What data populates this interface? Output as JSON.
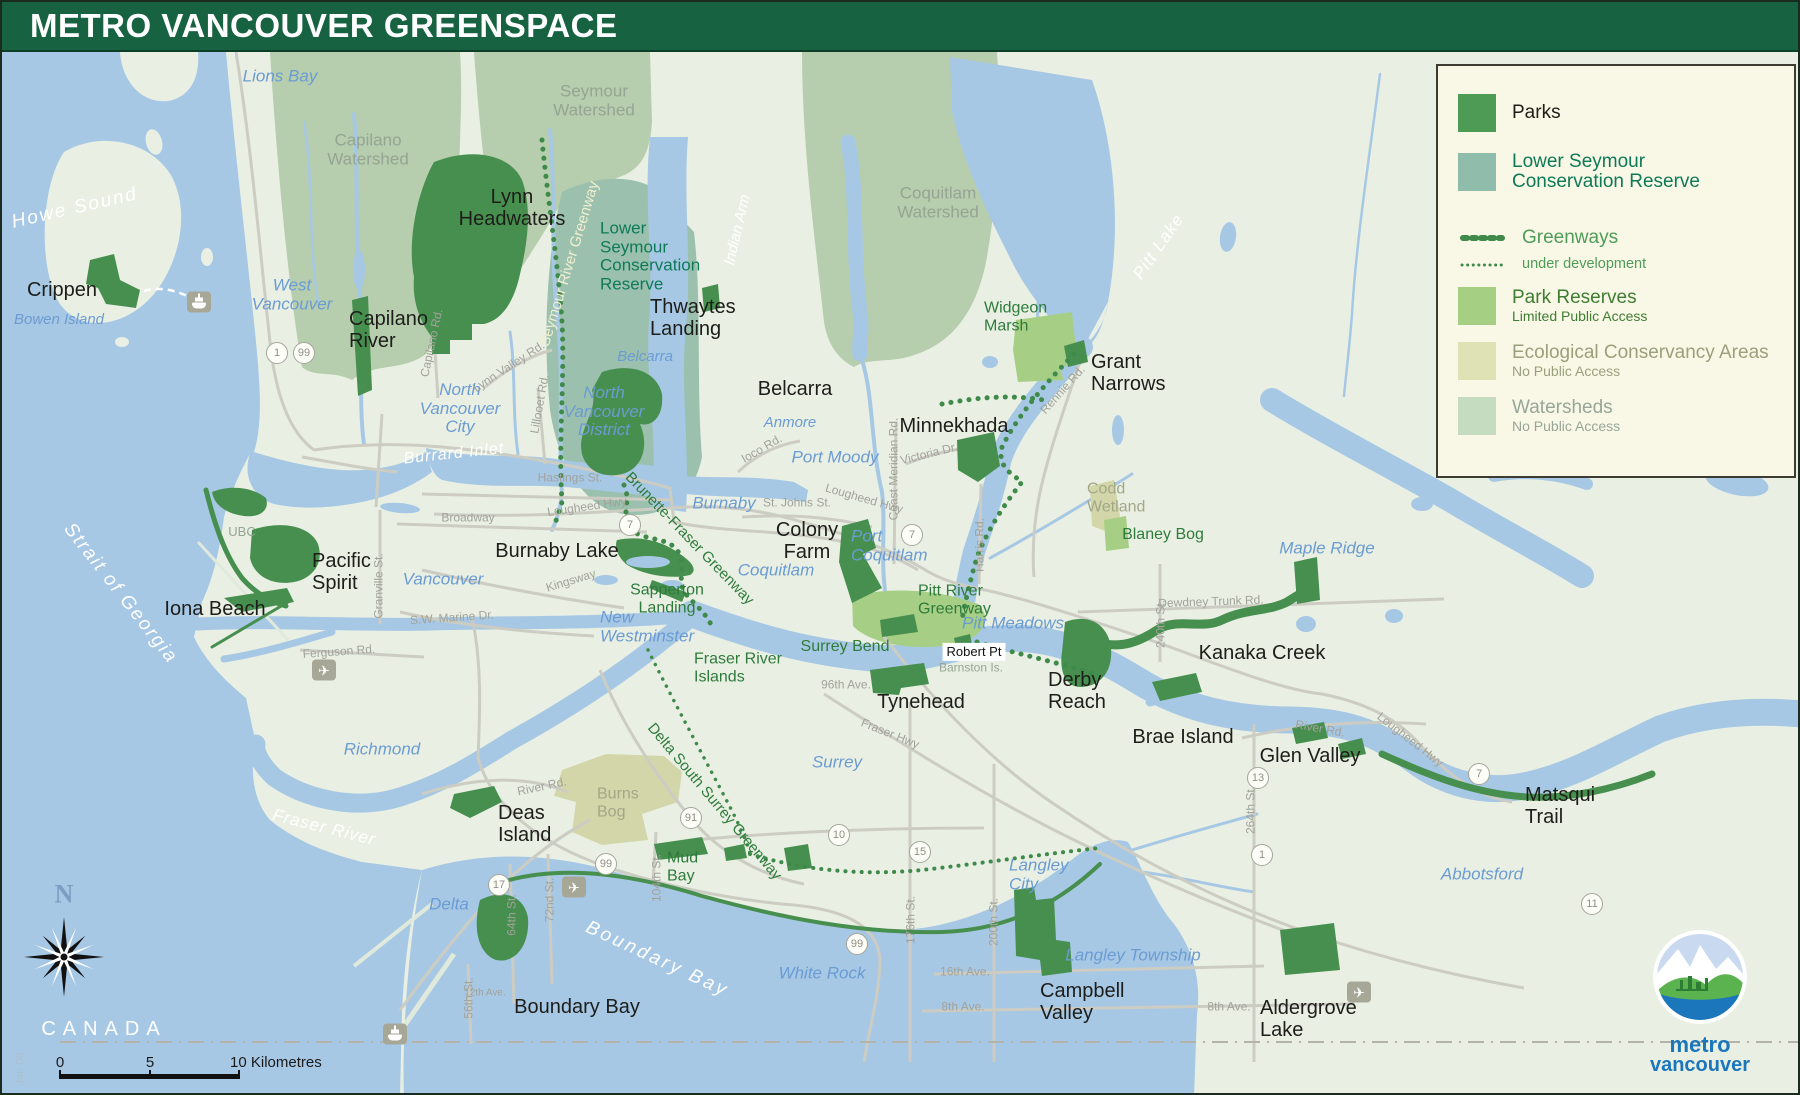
{
  "title": "METRO VANCOUVER GREENSPACE",
  "legend": {
    "items": [
      {
        "label": "Parks",
        "swatch": "#4e9b55"
      },
      {
        "label": "Lower Seymour\nConservation Reserve",
        "swatch": "#8fbcab"
      },
      {
        "label": "Greenways"
      },
      {
        "label": "under development"
      },
      {
        "label": "Park Reserves",
        "sub": "Limited Public Access",
        "swatch": "#a5cf82"
      },
      {
        "label": "Ecological Conservancy Areas",
        "sub": "No Public Access",
        "swatch": "#dfe2b5"
      },
      {
        "label": "Watersheds",
        "sub": "No Public Access",
        "swatch": "#c5dcc1"
      }
    ]
  },
  "colors": {
    "header": "#176341",
    "water": "#a7c8e4",
    "land": "#e9f0e3",
    "watershed": "#b6ceae",
    "lscr": "#9bc0ae",
    "park": "#478f4f",
    "park_reserve": "#a6cf85",
    "ecological": "#d3d6a8",
    "greenway": "#3f8a4a",
    "road": "#ccccc3",
    "city_text": "#6b9bd3",
    "logo_blue": "#1c76bc"
  },
  "scalebar": {
    "zero": "0",
    "five": "5",
    "ten": "10 Kilometres"
  },
  "logo": {
    "line1": "metro",
    "line2": "vancouver"
  },
  "map": {
    "labels": [
      {
        "t": "Howe Sound",
        "x": 73,
        "y": 207,
        "c": "water",
        "r": -13,
        "fs": 19,
        "ls": 2
      },
      {
        "t": "Burrard Inlet",
        "x": 452,
        "y": 452,
        "c": "water",
        "r": -6,
        "fs": 16,
        "ls": 1
      },
      {
        "t": "Indian Arm",
        "x": 736,
        "y": 228,
        "c": "water",
        "r": -77,
        "fs": 15
      },
      {
        "t": "Pitt Lake",
        "x": 1157,
        "y": 245,
        "c": "water",
        "r": -55,
        "fs": 17,
        "ls": 1
      },
      {
        "t": "Strait of Georgia",
        "x": 118,
        "y": 592,
        "c": "water",
        "r": 52,
        "fs": 19,
        "ls": 2
      },
      {
        "t": "Fraser River",
        "x": 322,
        "y": 826,
        "c": "water",
        "r": 14,
        "fs": 17,
        "ls": 1
      },
      {
        "t": "Boundary Bay",
        "x": 655,
        "y": 958,
        "c": "water",
        "r": 25,
        "fs": 19,
        "ls": 3
      },
      {
        "t": "CANADA",
        "x": 102,
        "y": 1027,
        "c": "canada"
      },
      {
        "t": "Lions Bay",
        "x": 278,
        "y": 75,
        "c": "city"
      },
      {
        "t": "West\nVancouver",
        "x": 290,
        "y": 293,
        "c": "city"
      },
      {
        "t": "Bowen Island",
        "x": 57,
        "y": 318,
        "c": "city",
        "fs": 15
      },
      {
        "t": "North\nVancouver\nCity",
        "x": 458,
        "y": 407,
        "c": "city"
      },
      {
        "t": "North\nVancouver\nDistrict",
        "x": 602,
        "y": 410,
        "c": "city"
      },
      {
        "t": "Belcarra",
        "x": 643,
        "y": 355,
        "c": "city",
        "fs": 15
      },
      {
        "t": "Anmore",
        "x": 788,
        "y": 421,
        "c": "city",
        "fs": 15
      },
      {
        "t": "Port Moody",
        "x": 833,
        "y": 456,
        "c": "city"
      },
      {
        "t": "Burnaby",
        "x": 722,
        "y": 502,
        "c": "city"
      },
      {
        "t": "Vancouver",
        "x": 441,
        "y": 578,
        "c": "city"
      },
      {
        "t": "Coquitlam",
        "x": 774,
        "y": 569,
        "c": "city"
      },
      {
        "t": "Port\nCoquitlam",
        "x": 849,
        "y": 544,
        "c": "city",
        "a": "l"
      },
      {
        "t": "New\nWestminster",
        "x": 598,
        "y": 625,
        "c": "city",
        "a": "l"
      },
      {
        "t": "Pitt Meadows",
        "x": 1011,
        "y": 622,
        "c": "city"
      },
      {
        "t": "Maple Ridge",
        "x": 1325,
        "y": 547,
        "c": "city"
      },
      {
        "t": "Richmond",
        "x": 380,
        "y": 748,
        "c": "city"
      },
      {
        "t": "Delta",
        "x": 447,
        "y": 903,
        "c": "city"
      },
      {
        "t": "Surrey",
        "x": 835,
        "y": 761,
        "c": "city"
      },
      {
        "t": "White Rock",
        "x": 820,
        "y": 972,
        "c": "city"
      },
      {
        "t": "Langley\nCity",
        "x": 1007,
        "y": 873,
        "c": "city",
        "a": "l"
      },
      {
        "t": "Langley Township",
        "x": 1131,
        "y": 954,
        "c": "city"
      },
      {
        "t": "Abbotsford",
        "x": 1480,
        "y": 873,
        "c": "city"
      },
      {
        "t": "Capilano\nWatershed",
        "x": 366,
        "y": 148,
        "c": "ws"
      },
      {
        "t": "Seymour\nWatershed",
        "x": 592,
        "y": 99,
        "c": "ws"
      },
      {
        "t": "Coquitlam\nWatershed",
        "x": 936,
        "y": 201,
        "c": "ws"
      },
      {
        "t": "UBC",
        "x": 240,
        "y": 530,
        "c": "ws",
        "fs": 13
      },
      {
        "t": "Barnston Is.",
        "x": 969,
        "y": 666,
        "c": "ws",
        "fs": 12
      },
      {
        "t": "Burns\nBog",
        "x": 595,
        "y": 801,
        "c": "bog",
        "a": "l"
      },
      {
        "t": "Codd\nWetland",
        "x": 1085,
        "y": 496,
        "c": "bog",
        "a": "l"
      },
      {
        "t": "Crippen",
        "x": 60,
        "y": 288,
        "c": "park"
      },
      {
        "t": "Capilano\nRiver",
        "x": 347,
        "y": 328,
        "c": "park",
        "a": "l"
      },
      {
        "t": "Lynn\nHeadwaters",
        "x": 510,
        "y": 206,
        "c": "park"
      },
      {
        "t": "Thwaytes\nLanding",
        "x": 648,
        "y": 316,
        "c": "park",
        "a": "l"
      },
      {
        "t": "Belcarra",
        "x": 793,
        "y": 387,
        "c": "park"
      },
      {
        "t": "Minnekhada",
        "x": 952,
        "y": 424,
        "c": "park"
      },
      {
        "t": "Grant\nNarrows",
        "x": 1089,
        "y": 371,
        "c": "park",
        "a": "l"
      },
      {
        "t": "Colony\nFarm",
        "x": 805,
        "y": 539,
        "c": "park"
      },
      {
        "t": "Burnaby Lake",
        "x": 555,
        "y": 549,
        "c": "park"
      },
      {
        "t": "Pacific\nSpirit",
        "x": 310,
        "y": 570,
        "c": "park",
        "a": "l"
      },
      {
        "t": "Iona Beach",
        "x": 213,
        "y": 607,
        "c": "park"
      },
      {
        "t": "Tynehead",
        "x": 919,
        "y": 700,
        "c": "park"
      },
      {
        "t": "Derby\nReach",
        "x": 1046,
        "y": 689,
        "c": "park",
        "a": "l"
      },
      {
        "t": "Brae Island",
        "x": 1181,
        "y": 735,
        "c": "park"
      },
      {
        "t": "Glen Valley",
        "x": 1308,
        "y": 754,
        "c": "park"
      },
      {
        "t": "Kanaka Creek",
        "x": 1260,
        "y": 651,
        "c": "park"
      },
      {
        "t": "Matsqui\nTrail",
        "x": 1523,
        "y": 804,
        "c": "park",
        "a": "l"
      },
      {
        "t": "Deas\nIsland",
        "x": 496,
        "y": 822,
        "c": "park",
        "a": "l"
      },
      {
        "t": "Boundary Bay",
        "x": 575,
        "y": 1005,
        "c": "park"
      },
      {
        "t": "Campbell\nValley",
        "x": 1038,
        "y": 1000,
        "c": "park",
        "a": "l"
      },
      {
        "t": "Aldergrove\nLake",
        "x": 1258,
        "y": 1017,
        "c": "park",
        "a": "l"
      },
      {
        "t": "Robert Pt",
        "x": 972,
        "y": 650,
        "c": "chip",
        "fs": 13
      },
      {
        "t": "Widgeon\nMarsh",
        "x": 982,
        "y": 315,
        "c": "gw",
        "a": "l"
      },
      {
        "t": "Blaney Bog",
        "x": 1161,
        "y": 533,
        "c": "gw"
      },
      {
        "t": "Pitt River\nGreenway",
        "x": 916,
        "y": 598,
        "c": "gw",
        "a": "l"
      },
      {
        "t": "Surrey Bend",
        "x": 843,
        "y": 645,
        "c": "gw"
      },
      {
        "t": "Fraser River\nIslands",
        "x": 692,
        "y": 666,
        "c": "gw",
        "a": "l"
      },
      {
        "t": "Sapperton\nLanding",
        "x": 665,
        "y": 597,
        "c": "gw"
      },
      {
        "t": "Mud\nBay",
        "x": 665,
        "y": 865,
        "c": "gw",
        "a": "l"
      },
      {
        "t": "Brunette-Fraser Greenway",
        "x": 687,
        "y": 537,
        "c": "gw",
        "r": 46,
        "fs": 15
      },
      {
        "t": "Delta South Surrey Greenway",
        "x": 712,
        "y": 800,
        "c": "gw",
        "r": 50,
        "fs": 15
      },
      {
        "t": "Seymour River Greenway",
        "x": 568,
        "y": 262,
        "c": "gw gwc",
        "r": -73,
        "fs": 15
      },
      {
        "t": "Lower\nSeymour\nConservation\nReserve",
        "x": 598,
        "y": 255,
        "c": "lscr",
        "a": "l"
      },
      {
        "t": "Hastings St.",
        "x": 568,
        "y": 476,
        "c": "road"
      },
      {
        "t": "Broadway",
        "x": 466,
        "y": 516,
        "c": "road"
      },
      {
        "t": "Lougheed Hwy",
        "x": 585,
        "y": 505,
        "c": "road",
        "r": -8
      },
      {
        "t": "St. Johns St.",
        "x": 795,
        "y": 501,
        "c": "road"
      },
      {
        "t": "Lougheed Hwy",
        "x": 862,
        "y": 497,
        "c": "road",
        "r": 16
      },
      {
        "t": "Lougheed Hwy",
        "x": 1408,
        "y": 738,
        "c": "road",
        "r": 38
      },
      {
        "t": "Kingsway",
        "x": 569,
        "y": 579,
        "c": "road",
        "r": -17
      },
      {
        "t": "Granville St.",
        "x": 377,
        "y": 584,
        "c": "road",
        "r": -90
      },
      {
        "t": "S.W. Marine Dr.",
        "x": 450,
        "y": 616,
        "c": "road",
        "r": -4
      },
      {
        "t": "Ferguson Rd.",
        "x": 337,
        "y": 650,
        "c": "road",
        "r": -4
      },
      {
        "t": "Ioco Rd.",
        "x": 760,
        "y": 447,
        "c": "road",
        "r": -30
      },
      {
        "t": "Coast Meridian Rd.",
        "x": 892,
        "y": 467,
        "c": "road",
        "r": -90
      },
      {
        "t": "Victoria Dr.",
        "x": 927,
        "y": 452,
        "c": "road",
        "r": -14
      },
      {
        "t": "Harris Rd.",
        "x": 978,
        "y": 543,
        "c": "road",
        "r": -90
      },
      {
        "t": "Rennie Rd.",
        "x": 1061,
        "y": 388,
        "c": "road",
        "r": -48
      },
      {
        "t": "Dewdney Trunk Rd.",
        "x": 1209,
        "y": 600,
        "c": "road",
        "r": -2
      },
      {
        "t": "240th St.",
        "x": 1159,
        "y": 622,
        "c": "road",
        "r": -90
      },
      {
        "t": "River Rd.",
        "x": 540,
        "y": 785,
        "c": "road",
        "r": -12
      },
      {
        "t": "River Rd.",
        "x": 1318,
        "y": 727,
        "c": "road",
        "r": 10
      },
      {
        "t": "96th Ave.",
        "x": 844,
        "y": 683,
        "c": "road"
      },
      {
        "t": "Fraser Hwy",
        "x": 888,
        "y": 732,
        "c": "road",
        "r": 22
      },
      {
        "t": "264th St.",
        "x": 1249,
        "y": 808,
        "c": "road",
        "r": -90
      },
      {
        "t": "176th St.",
        "x": 909,
        "y": 918,
        "c": "road",
        "r": -90
      },
      {
        "t": "200th St.",
        "x": 992,
        "y": 920,
        "c": "road",
        "r": -90
      },
      {
        "t": "16th Ave.",
        "x": 963,
        "y": 970,
        "c": "road"
      },
      {
        "t": "8th Ave.",
        "x": 961,
        "y": 1005,
        "c": "road"
      },
      {
        "t": "8th Ave.",
        "x": 1227,
        "y": 1005,
        "c": "road"
      },
      {
        "t": "64th St.",
        "x": 510,
        "y": 913,
        "c": "road",
        "r": -90
      },
      {
        "t": "72nd St.",
        "x": 548,
        "y": 898,
        "c": "road",
        "r": -90
      },
      {
        "t": "56th St.",
        "x": 467,
        "y": 996,
        "c": "road",
        "r": -90
      },
      {
        "t": "104th St.",
        "x": 655,
        "y": 876,
        "c": "road",
        "r": -90
      },
      {
        "t": "12th Ave.",
        "x": 483,
        "y": 991,
        "c": "road",
        "fs": 10
      },
      {
        "t": "Capilano Rd.",
        "x": 430,
        "y": 341,
        "c": "road",
        "r": -78
      },
      {
        "t": "Lynn Valley Rd.",
        "x": 507,
        "y": 365,
        "c": "road",
        "r": -33
      },
      {
        "t": "Lillooet Rd.",
        "x": 538,
        "y": 402,
        "c": "road",
        "r": -80
      },
      {
        "t": "N",
        "x": 62,
        "y": 893,
        "c": "compassN"
      },
      {
        "t": "Jan 08",
        "x": 18,
        "y": 1067,
        "c": "janv",
        "r": -90
      }
    ],
    "shields": [
      {
        "n": "1",
        "x": 275,
        "y": 351
      },
      {
        "n": "99",
        "x": 302,
        "y": 351
      },
      {
        "n": "7",
        "x": 628,
        "y": 523
      },
      {
        "n": "7",
        "x": 910,
        "y": 533
      },
      {
        "n": "7",
        "x": 1477,
        "y": 772
      },
      {
        "n": "91",
        "x": 689,
        "y": 816
      },
      {
        "n": "99",
        "x": 604,
        "y": 862
      },
      {
        "n": "99",
        "x": 855,
        "y": 942
      },
      {
        "n": "17",
        "x": 497,
        "y": 883
      },
      {
        "n": "10",
        "x": 837,
        "y": 833
      },
      {
        "n": "15",
        "x": 918,
        "y": 850
      },
      {
        "n": "1",
        "x": 1260,
        "y": 853
      },
      {
        "n": "13",
        "x": 1256,
        "y": 776
      },
      {
        "n": "11",
        "x": 1590,
        "y": 902
      }
    ],
    "icons": {
      "ferries": [
        {
          "x": 197,
          "y": 300
        },
        {
          "x": 393,
          "y": 1032
        }
      ],
      "airports": [
        {
          "x": 322,
          "y": 668
        },
        {
          "x": 572,
          "y": 885
        },
        {
          "x": 1357,
          "y": 990
        }
      ]
    }
  }
}
